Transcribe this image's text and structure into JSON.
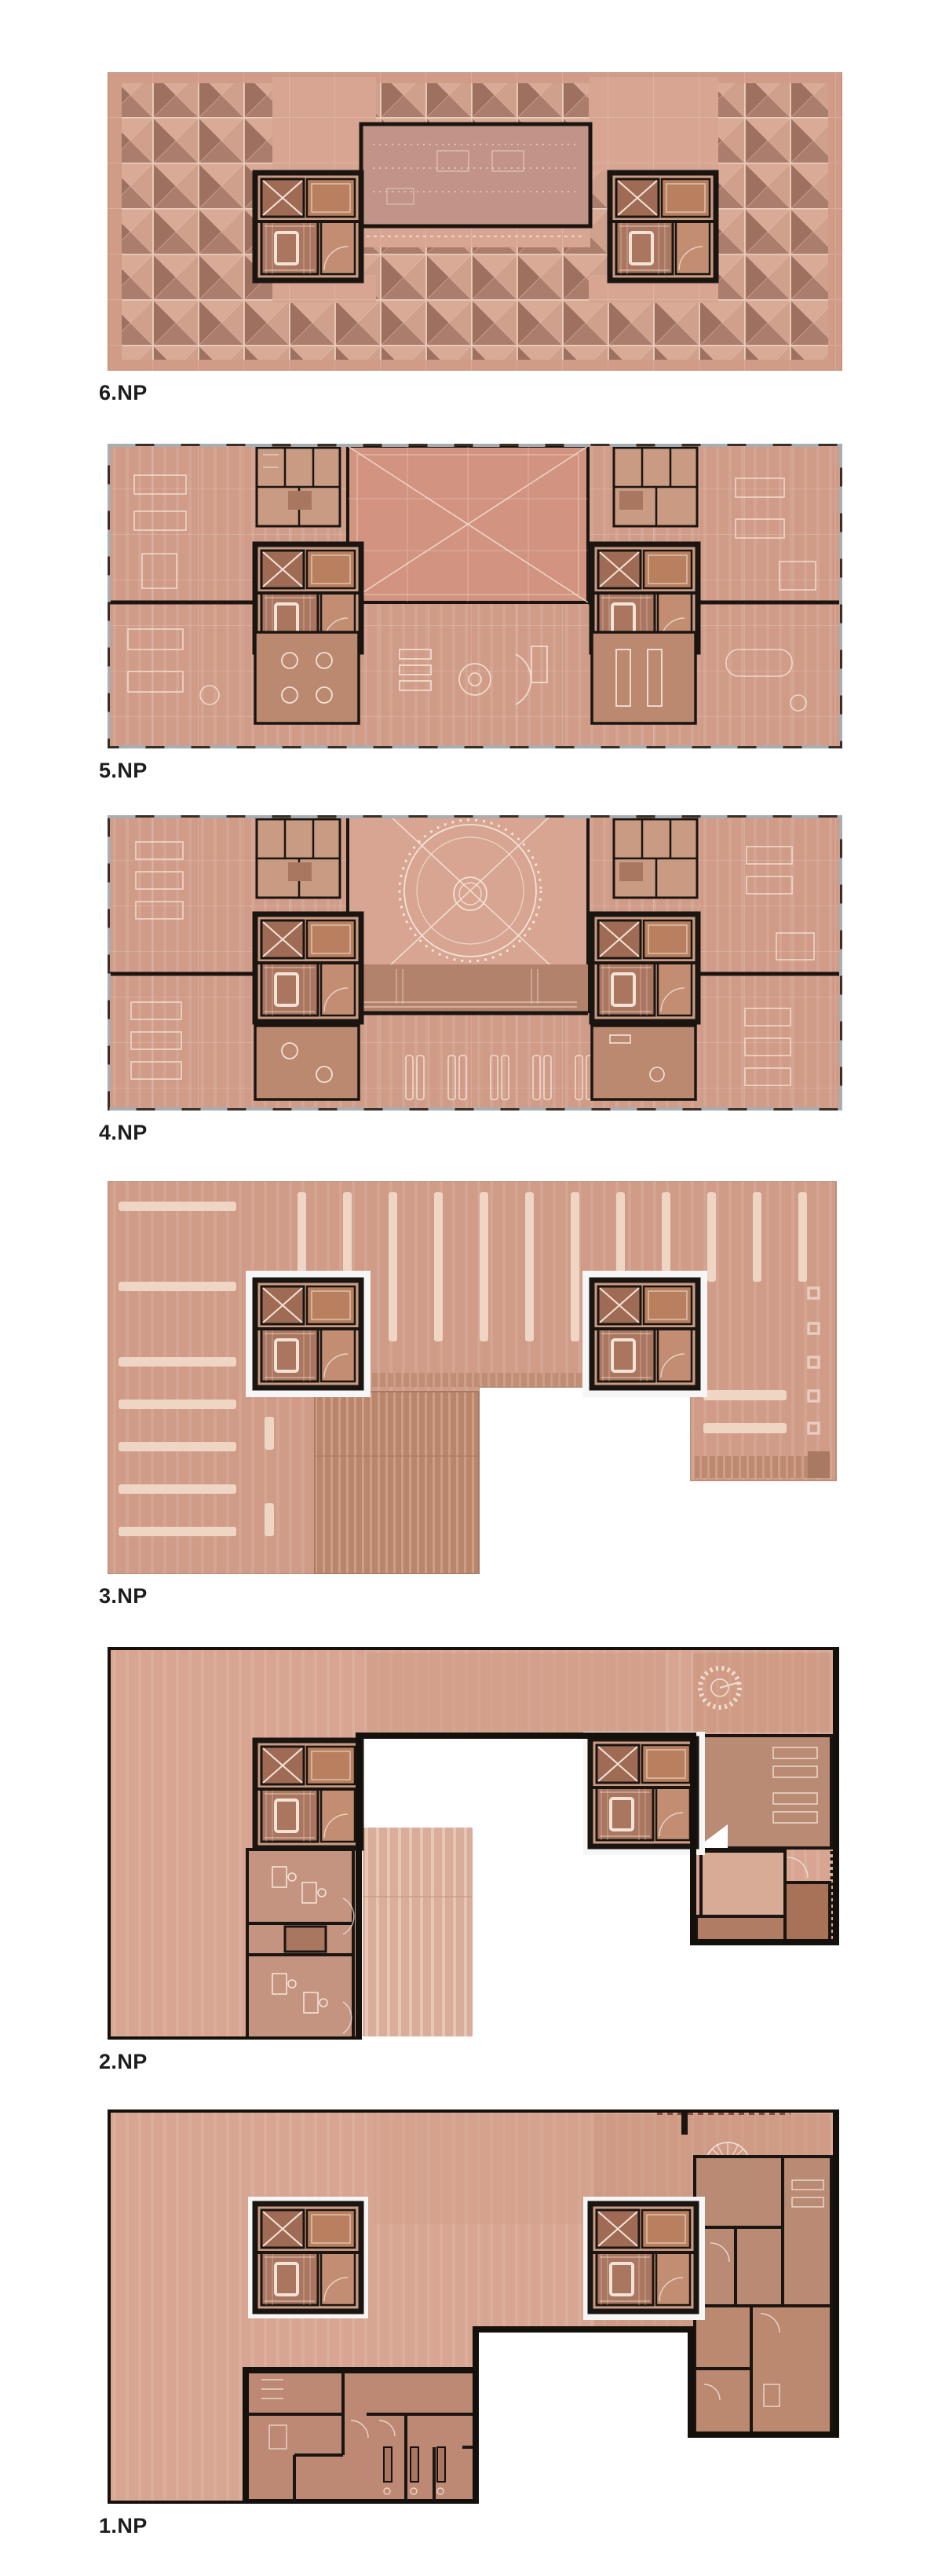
{
  "document": {
    "title": "Floor plan set 1.NP - 6.NP",
    "background": "#ffffff"
  },
  "floors": [
    {
      "id": "6np",
      "label": "6.NP",
      "description": "roof floor with pyramid skylight grid, central penthouse volume and two cores"
    },
    {
      "id": "5np",
      "label": "5.NP",
      "description": "full office floor with central atrium void, two cores, meeting rooms and furniture"
    },
    {
      "id": "4np",
      "label": "4.NP",
      "description": "full office floor with circular auditorium ceiling feature, stage band and two cores"
    },
    {
      "id": "3np",
      "label": "3.NP",
      "description": "U-shaped parking level with striped stalls, ramp and two free-standing cores"
    },
    {
      "id": "2np",
      "label": "2.NP",
      "description": "U-shaped level with heavy perimeter wall, offices, ramp, spiral stair and two cores"
    },
    {
      "id": "1np",
      "label": "1.NP",
      "description": "U-shaped ground floor with entrance, sanitary block, radial stair and two cores"
    }
  ],
  "palette": {
    "pageBg": "#ffffff",
    "wall": "#1a1510",
    "base": "#d09b87",
    "baseLight": "#dcb09d",
    "baseSoft": "#d7a591",
    "stripe": "#eed5c4",
    "roomDark": "#a9765f",
    "roomMid": "#bb8870",
    "coreFill": "#c99b83",
    "elevator": "#a06b54",
    "penthouse": "#c29488",
    "atrium": "#d29480",
    "sill": "#a7adb1",
    "whiteLine": "#f3e3d6",
    "rampDark": "#b8866c",
    "rampStripe": "#cf9e85",
    "label": "#1d1d1d"
  }
}
